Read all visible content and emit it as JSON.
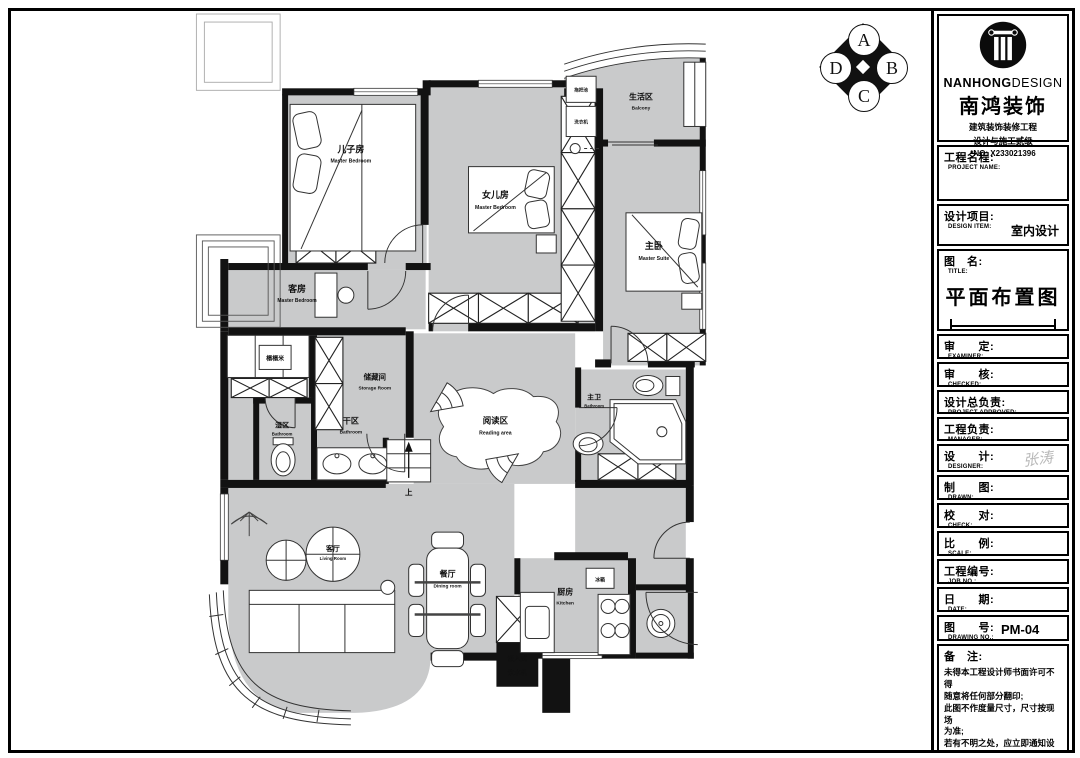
{
  "stamp": {
    "top": "A",
    "right": "B",
    "bottom": "C",
    "left": "D"
  },
  "logo": {
    "brand_bold": "NANHONG",
    "brand_light": "DESIGN",
    "brand_cn": "南鸿装饰",
    "cert1": "建筑装饰装修工程",
    "cert2": "设计与施工贰级",
    "license": "*NO: X233021396"
  },
  "title_block": {
    "project_name": {
      "cn": "工程名程:",
      "en": "PROJECT NAME:"
    },
    "design_item": {
      "cn": "设计项目:",
      "en": "DESIGN ITEM:",
      "value": "室内设计"
    },
    "drawing_title": {
      "cn": "图　名:",
      "en": "TITLE:",
      "value": "平面布置图"
    },
    "examiner": {
      "cn": "审　　定:",
      "en": "EXAMINER:"
    },
    "checked": {
      "cn": "审　　核:",
      "en": "CHECKED:"
    },
    "project_approved": {
      "cn": "设计总负责:",
      "en": "PROJECT APPROVED:"
    },
    "manager": {
      "cn": "工程负责:",
      "en": "MANAGER:"
    },
    "designer": {
      "cn": "设　　计:",
      "en": "DESIGNER:",
      "signature": "张涛"
    },
    "drawn": {
      "cn": "制　　图:",
      "en": "DRAWN:"
    },
    "check": {
      "cn": "校　　对:",
      "en": "CHECK:"
    },
    "scale": {
      "cn": "比　　例:",
      "en": "SCALE:"
    },
    "job_no": {
      "cn": "工程编号:",
      "en": "JOB NO.:"
    },
    "date": {
      "cn": "日　　期:",
      "en": "DATE:"
    },
    "drawing_no": {
      "cn": "图　　号:",
      "en": "DRAWING NO.:",
      "value": "PM-04"
    },
    "notes": {
      "cn": "备　注:",
      "text": "未得本工程设计师书面许可不得\n随意将任何部分翻印;\n此图不作度量尺寸，尺寸按现场\n为准;\n若有不明之处，应立即通知设计\n师。",
      "fine_print": "本设计解释权归设计师所有。"
    }
  },
  "plan": {
    "rooms": {
      "son_bedroom": {
        "cn": "儿子房",
        "en": "Master Bedroom"
      },
      "daughter_bedroom": {
        "cn": "女儿房",
        "en": "Master Bedroom"
      },
      "master_bedroom": {
        "cn": "主卧",
        "en": "Master Suite"
      },
      "balcony": {
        "cn": "生活区",
        "en": "Balcony"
      },
      "guest_bedroom": {
        "cn": "客房",
        "en": "Master Bedroom"
      },
      "tatami": {
        "cn": "榻榻米"
      },
      "storage": {
        "cn": "储藏间",
        "en": "Storage Room"
      },
      "wet_area": {
        "cn": "湿区",
        "en": "Bathroom"
      },
      "dry_area": {
        "cn": "干区",
        "en": "Bathroom"
      },
      "reading": {
        "cn": "阅读区",
        "en": "Reading area"
      },
      "master_bath": {
        "cn": "主卫",
        "en": "Bathroom"
      },
      "living": {
        "cn": "客厅",
        "en": "Living Room"
      },
      "dining": {
        "cn": "餐厅",
        "en": "Dining room"
      },
      "kitchen": {
        "cn": "厨房",
        "en": "Kitchen"
      }
    },
    "fixtures": {
      "built_in_line1": "嵌入式",
      "built_in_line2": "饮水机",
      "fridge": "冰箱",
      "mop_sink": "拖把池",
      "washer": "洗衣机",
      "stair_up": "上"
    }
  }
}
